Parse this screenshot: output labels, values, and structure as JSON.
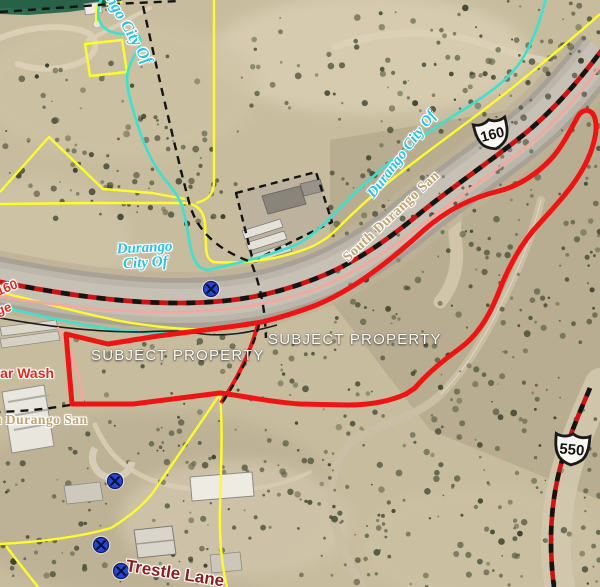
{
  "map": {
    "title": "Subject property aerial parcel map",
    "labels": {
      "durango_city_top": "Durango City Of",
      "durango_city_mid_line1": "Durango",
      "durango_city_mid_line2": "City Of",
      "durango_city_diag": "Durango City Of",
      "south_durango_san": "South Durango San",
      "n_durango_san": "n Durango San",
      "hwy160_partial": "160",
      "frontage_partial": "ge",
      "car_wash": "Car Wash",
      "subject_property_1": "SUBJECT PROPERTY",
      "subject_property_2": "SUBJECT PROPERTY",
      "trestle_lane": "Trestle Lane"
    },
    "shields": {
      "us160": "160",
      "us550": "550"
    },
    "icons": {
      "utility_marker": "circle-x-utility-marker",
      "us_route_shield": "us-route-shield"
    },
    "colors": {
      "subject_boundary_red": "#ee1414",
      "route_line_red": "#cc1212",
      "route_dash_black": "#141414",
      "parcel_yellow": "#fdfd2e",
      "city_limit_cyan": "#3fe0cd",
      "city_label_cyan": "#2cc3e2",
      "sanitation_salmon": "#f5a79e",
      "utility_marker_blue": "#2746d8",
      "road_label_red": "#de2b24",
      "trestle_label_maroon": "#8b1d1d",
      "district_label_khaki": "#bfa26d",
      "green_field": "#2e6b4f"
    }
  }
}
